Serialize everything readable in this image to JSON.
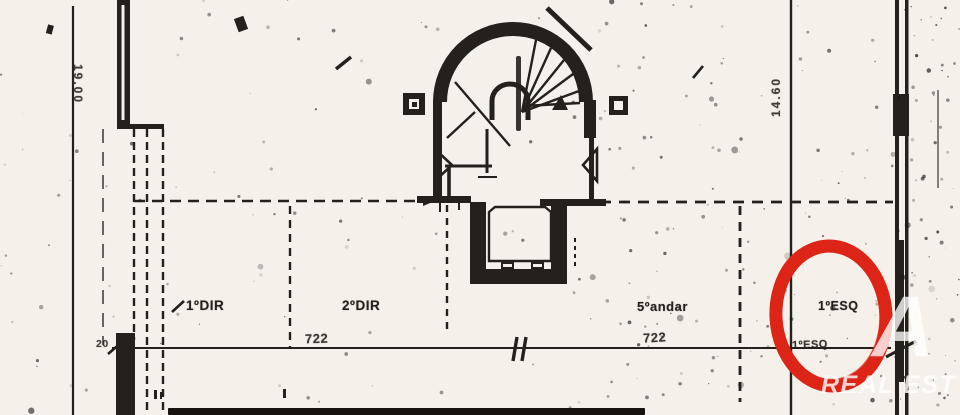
{
  "plan": {
    "units": [
      {
        "label": "1ºDIR"
      },
      {
        "label": "2ºDIR"
      },
      {
        "label": "5ºandar"
      },
      {
        "label": "1ºESQ"
      }
    ],
    "unit_label_secondary": "1ºESQ",
    "dimensions": {
      "left_vertical": "19.00",
      "right_vertical": "14.60",
      "bottom_left": "20",
      "span_left": "722",
      "span_right": "722"
    },
    "highlight": {
      "shape": "hand-drawn-circle",
      "color": "#dd2517",
      "target": "1ºESQ"
    },
    "watermark": {
      "letter": "A",
      "text": "REAL EST"
    },
    "colors": {
      "ink": "#24201c",
      "paper": "#f5f1ea",
      "red": "#dd2517"
    }
  }
}
